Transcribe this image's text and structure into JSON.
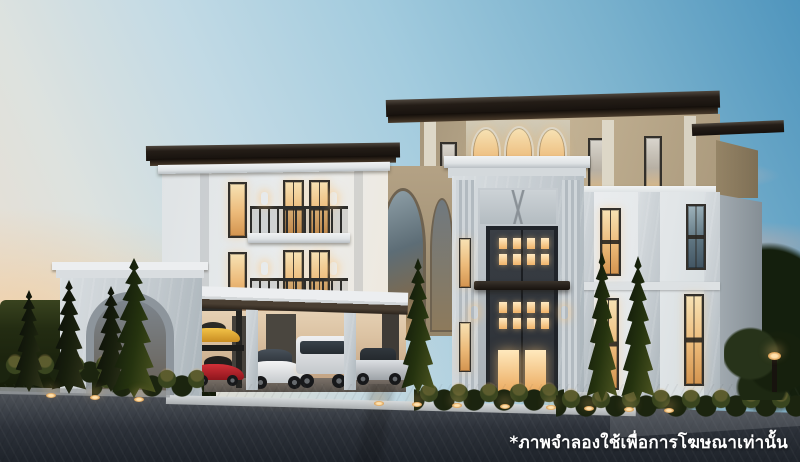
{
  "scene": {
    "type": "3d-architectural-rendering",
    "subject": "Luxury three-storey modern-classical mansion at dusk",
    "description": "Photorealistic dusk rendering of a white and beige modern classical luxury mansion with warm lit windows and arched glazing, a marble entrance portal with tall dark double door, a porte-cochere carport sheltering five cars (yellow sports car on a lift, red sports car, white sedan, white SUV, silver classic car), marble gate arch, cypress trees, clipped hedges, ground lights and a dark paved driveway under a blue-to-peach sunset sky",
    "time_of_day": "dusk"
  },
  "overlay": {
    "disclaimer": "*ภาพจำลองใช้เพื่อการโฆษณาเท่านั้น"
  },
  "palette": {
    "sky_top": "#5f9fc2",
    "sky_mid": "#b5d5e3",
    "sky_horizon_peach": "#ecd9c4",
    "sunset_cloud_pink": "#e7b5a8",
    "roof": "#241d17",
    "beige_wall": "#b7a689",
    "white_wall": "#e8ebee",
    "marble": "#cdd3d7",
    "window_glow": "#f0bd7a",
    "door": "#33373c",
    "foliage": "#1c2711",
    "driveway": "#2b3038",
    "car_yellow": "#e8b33a",
    "car_red": "#c0262e",
    "car_white": "#eef0f2",
    "car_silver": "#c2c6ca",
    "disclaimer_color": "#ffffff"
  }
}
